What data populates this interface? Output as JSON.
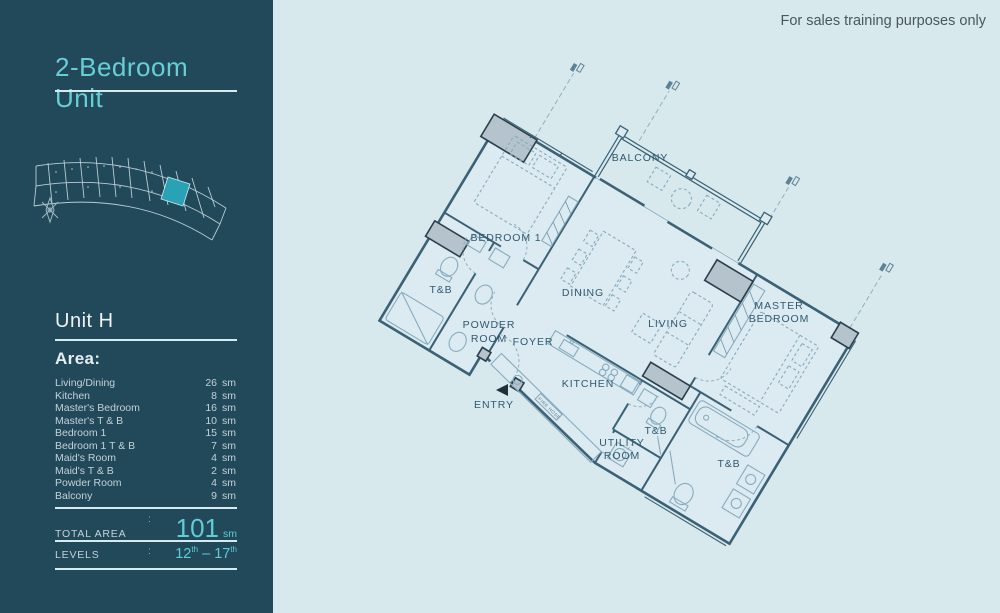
{
  "disclaimer": "For sales training purposes only",
  "sidebar": {
    "title": "2-Bedroom Unit",
    "unit_name": "Unit H",
    "area_heading": "Area:",
    "area_rows": [
      {
        "label": "Living/Dining",
        "value": "26",
        "unit": "sm"
      },
      {
        "label": "Kitchen",
        "value": "8",
        "unit": "sm"
      },
      {
        "label": "Master's Bedroom",
        "value": "16",
        "unit": "sm"
      },
      {
        "label": "Master's T & B",
        "value": "10",
        "unit": "sm"
      },
      {
        "label": "Bedroom 1",
        "value": "15",
        "unit": "sm"
      },
      {
        "label": "Bedroom 1 T & B",
        "value": "7",
        "unit": "sm"
      },
      {
        "label": "Maid's Room",
        "value": "4",
        "unit": "sm"
      },
      {
        "label": "Maid's T & B",
        "value": "2",
        "unit": "sm"
      },
      {
        "label": "Powder Room",
        "value": "4",
        "unit": "sm"
      },
      {
        "label": "Balcony",
        "value": "9",
        "unit": "sm"
      }
    ],
    "total": {
      "label": "TOTAL AREA",
      "colon": ":",
      "value": "101",
      "unit": "sm"
    },
    "levels": {
      "label": "LEVELS",
      "colon": ":",
      "from": "12",
      "from_sup": "th",
      "dash": "–",
      "to": "17",
      "to_sup": "th"
    }
  },
  "floorplan": {
    "labels": {
      "balcony": "BALCONY",
      "bedroom1": "BEDROOM 1",
      "dining": "DINING",
      "living": "LIVING",
      "master_line1": "MASTER",
      "master_line2": "BEDROOM",
      "tb_bedroom1": "T&B",
      "powder_line1": "POWDER",
      "powder_line2": "ROOM",
      "foyer": "FOYER",
      "entry": "ENTRY",
      "kitchen": "KITCHEN",
      "utility_line1": "UTILITY",
      "utility_line2": "ROOM",
      "tb_hall": "T&B",
      "tb_master": "T&B",
      "fire_hose": "FIRE HOSE"
    }
  },
  "colors": {
    "sidebar_bg": "#21495a",
    "accent_teal": "#5fccd8",
    "canvas_bg": "#d8e9ee",
    "plan_line": "#3a6175",
    "highlight_unit": "#2aa2b6"
  }
}
